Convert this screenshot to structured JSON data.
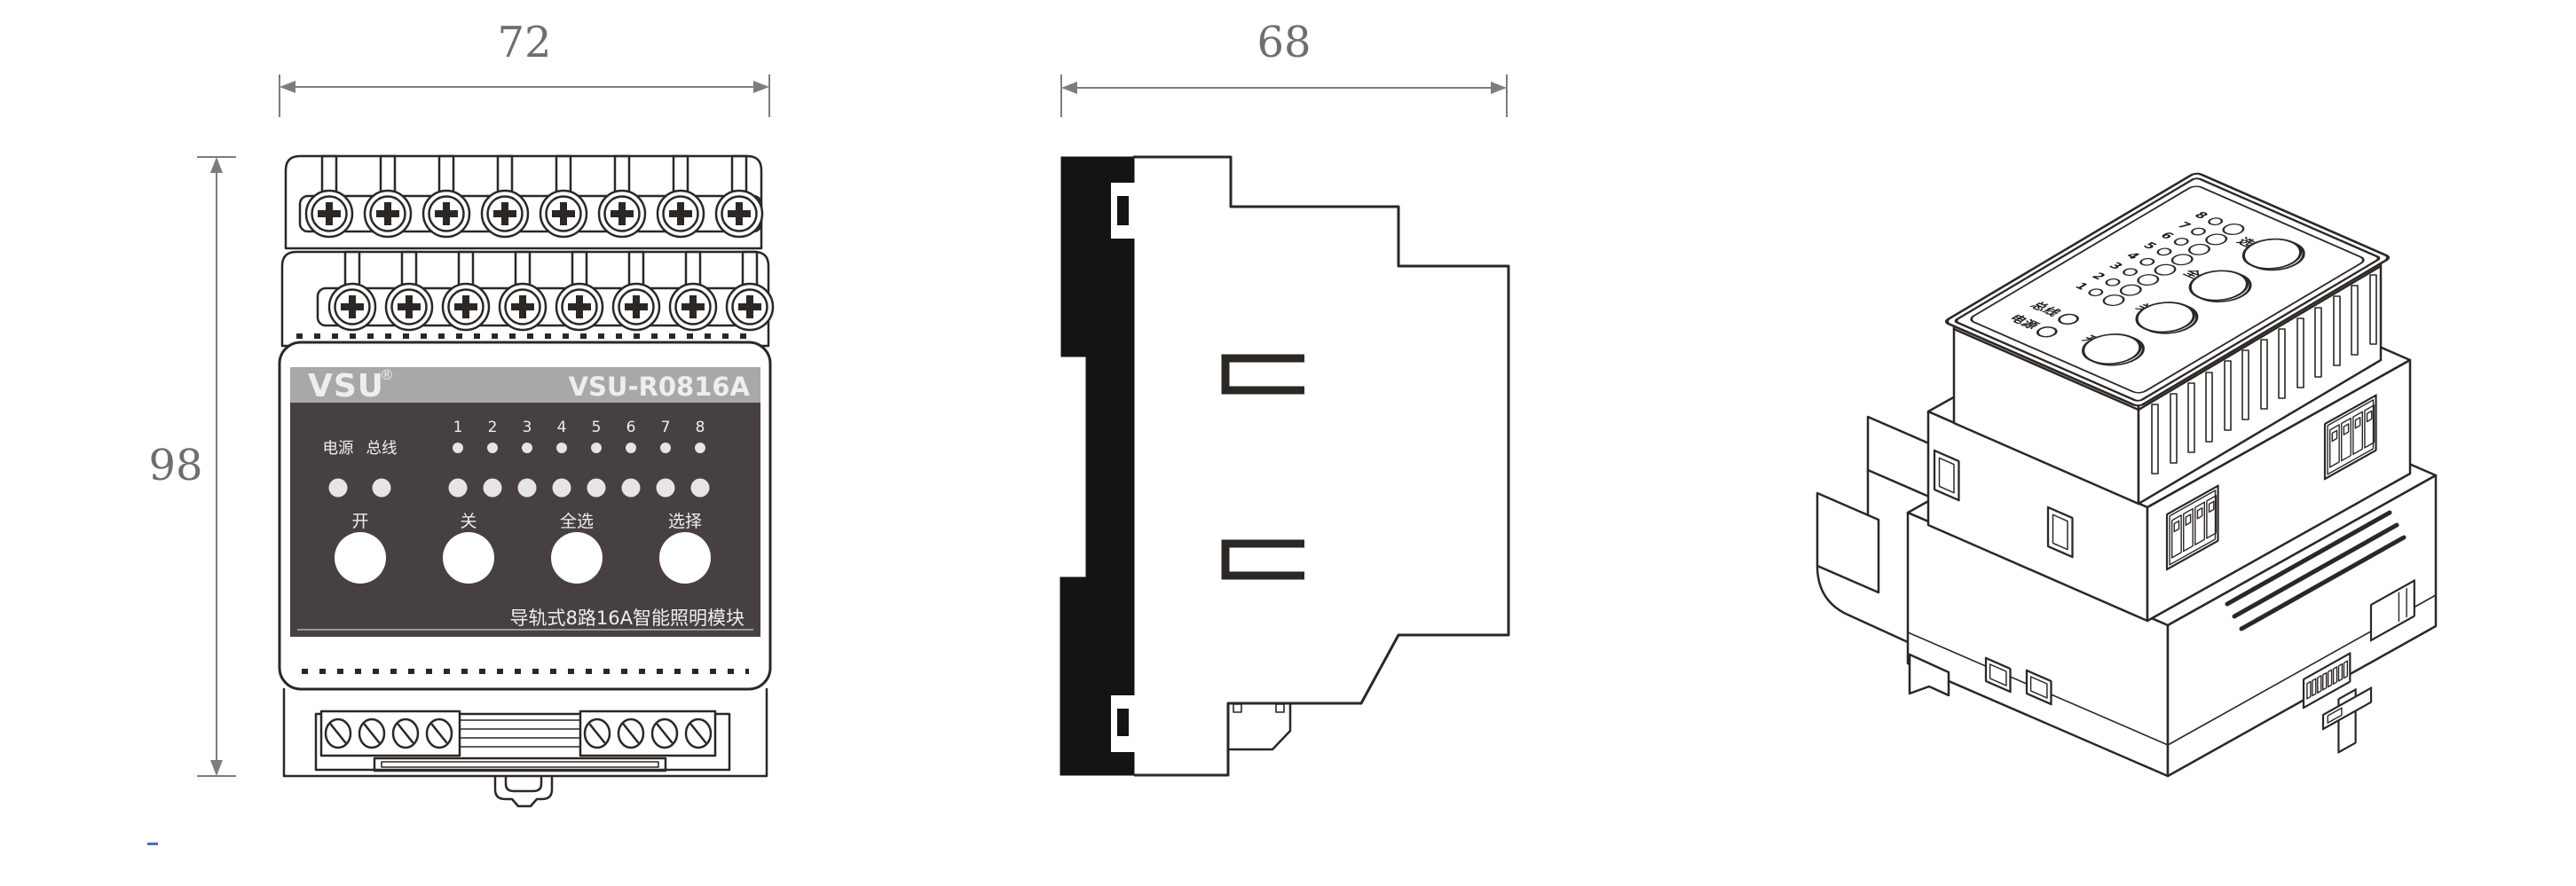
{
  "dimensions": {
    "front_width": "72",
    "front_height": "98",
    "side_depth": "68"
  },
  "module": {
    "brand": "VSU",
    "registered_mark": "®",
    "model": "VSU-R0816A",
    "power_led_label": "电源",
    "bus_led_label": "总线",
    "channels": [
      "1",
      "2",
      "3",
      "4",
      "5",
      "6",
      "7",
      "8"
    ],
    "button_on": "开",
    "button_off": "关",
    "button_select_all": "全选",
    "button_select": "选择",
    "caption": "导轨式8路16A智能照明模块"
  },
  "colors": {
    "line": "#2b2724",
    "dimension": "#7d7d7d",
    "band": "#a9a8a7",
    "panel": "#464140",
    "led": "#e6e5e3",
    "button_fill": "#ffffff",
    "panel_text": "#efeeec",
    "rail_black": "#161412",
    "cursor_dash": "#4a6fb5"
  }
}
